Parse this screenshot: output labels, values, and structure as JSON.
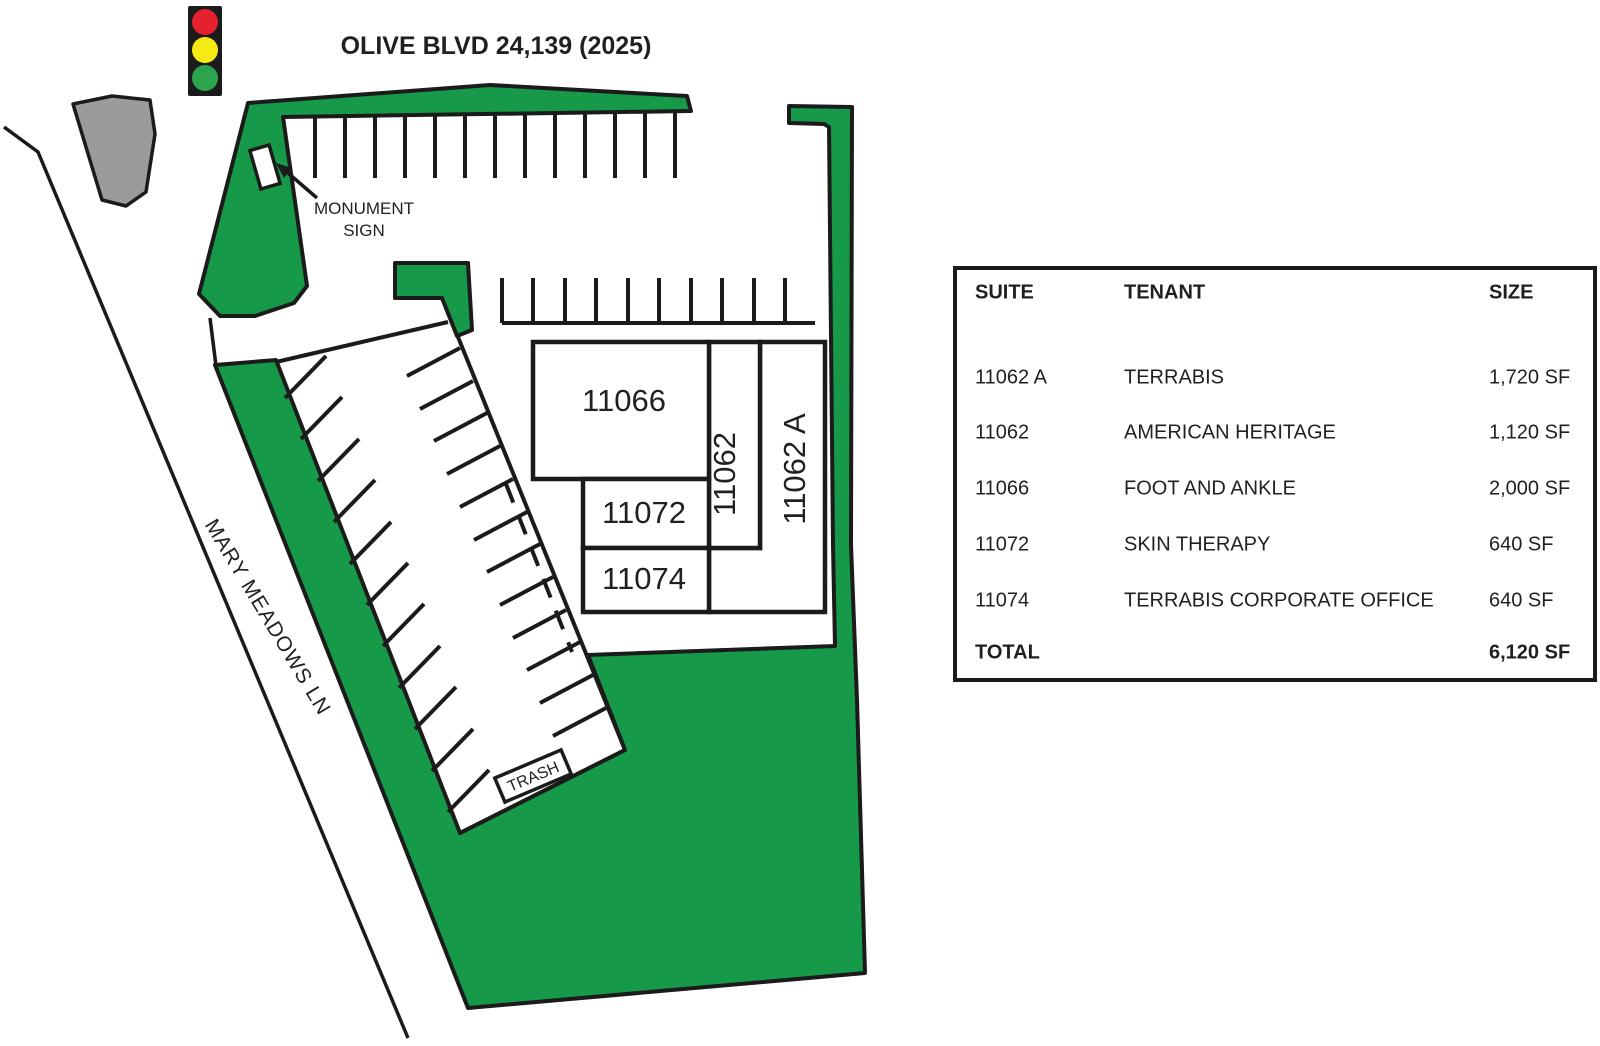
{
  "title": "OLIVE BLVD 24,139 (2025)",
  "colors": {
    "green": "#17994A",
    "traffic_green": "#2CA44D",
    "red": "#E5212E",
    "yellow": "#F5EB13",
    "gray": "#9B9B9B",
    "ink": "#1B1B1B"
  },
  "map": {
    "street_label": "MARY MEADOWS LN",
    "monument_sign_line1": "MONUMENT",
    "monument_sign_line2": "SIGN",
    "trash_label": "TRASH",
    "buildings": {
      "b11066": "11066",
      "b11072": "11072",
      "b11074": "11074",
      "b11062": "11062",
      "b11062a": "11062 A"
    }
  },
  "table": {
    "headers": {
      "suite": "SUITE",
      "tenant": "TENANT",
      "size": "SIZE"
    },
    "rows": [
      {
        "suite": "11062 A",
        "tenant": "TERRABIS",
        "size": "1,720 SF"
      },
      {
        "suite": "11062",
        "tenant": "AMERICAN HERITAGE",
        "size": "1,120 SF"
      },
      {
        "suite": "11066",
        "tenant": "FOOT AND ANKLE",
        "size": "2,000 SF"
      },
      {
        "suite": "11072",
        "tenant": "SKIN THERAPY",
        "size": "640 SF"
      },
      {
        "suite": "11074",
        "tenant": "TERRABIS CORPORATE OFFICE",
        "size": "640 SF"
      }
    ],
    "total": {
      "label": "TOTAL",
      "size": "6,120 SF"
    }
  }
}
